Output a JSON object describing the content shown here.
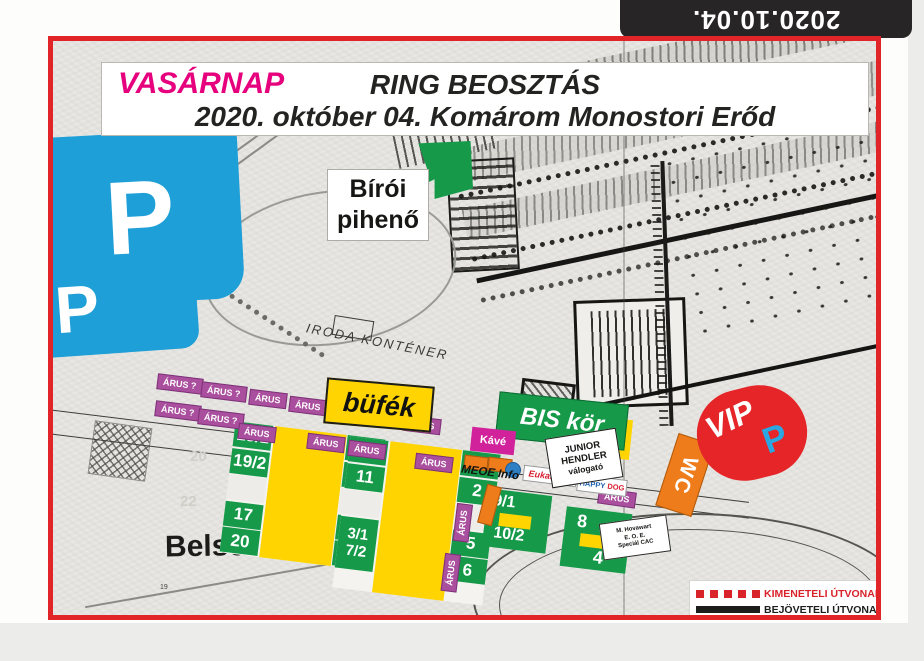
{
  "page": {
    "date_tag": "2020.10.04."
  },
  "header": {
    "day": "VASÁRNAP",
    "title": "RING BEOSZTÁS",
    "subtitle": "2020. október 04. Komárom Monostori Erőd"
  },
  "labels": {
    "parking_p": "P",
    "judge_rest_line1": "Bírói",
    "judge_rest_line2": "pihenő",
    "iroda": "IRODA KONTÉNER",
    "bufe": "büfék",
    "bis": "BIS kör",
    "kave": "Kávé",
    "junior_1": "JUNIOR",
    "junior_2": "HENDLER",
    "junior_3": "válogató",
    "meoe": "MEOE Info",
    "eukanuba": "Eukanuba",
    "happy_1": "HAPPY",
    "happy_2": "DOG",
    "wc": "WC",
    "vip": "VIP",
    "vip_p": "P",
    "belso": "Belso udvar",
    "hovawart_1": "M. Hovawart",
    "hovawart_2": "E. O. E.",
    "hovawart_3": "Speciál CAC"
  },
  "stalls": [
    {
      "t": "ÁRUS ?",
      "x": 104,
      "y": 335,
      "r": 7
    },
    {
      "t": "ÁRUS ?",
      "x": 148,
      "y": 343,
      "r": 7
    },
    {
      "t": "ÁRUS",
      "x": 196,
      "y": 350,
      "r": 7
    },
    {
      "t": "ÁRUS",
      "x": 236,
      "y": 357,
      "r": 7
    },
    {
      "t": "ÁRUS",
      "x": 350,
      "y": 376,
      "r": 7
    },
    {
      "t": "ÁRUS ?",
      "x": 102,
      "y": 362,
      "r": 7
    },
    {
      "t": "ÁRUS ?",
      "x": 145,
      "y": 370,
      "r": 7
    },
    {
      "t": "ÁRUS",
      "x": 185,
      "y": 384,
      "r": 7
    },
    {
      "t": "ÁRUS",
      "x": 254,
      "y": 394,
      "r": 7
    },
    {
      "t": "ÁRUS",
      "x": 295,
      "y": 401,
      "r": 7
    },
    {
      "t": "ÁRUS",
      "x": 362,
      "y": 414,
      "r": 7
    },
    {
      "t": "ÁRUS",
      "x": 391,
      "y": 474,
      "r": -83
    },
    {
      "t": "ÁRUS",
      "x": 379,
      "y": 524,
      "r": -83
    },
    {
      "t": "ÁRUS",
      "x": 545,
      "y": 449,
      "r": 8
    }
  ],
  "rings": {
    "block1": {
      "left": [
        "18/1",
        "19/2",
        "",
        "17",
        "20"
      ],
      "right": [
        "13",
        "14",
        "",
        "15",
        "16"
      ]
    },
    "block2": {
      "left": [
        "12",
        "11",
        "",
        "3/1\n7/2"
      ],
      "right": [
        "1",
        "2",
        "",
        "5",
        "6"
      ]
    },
    "block3": {
      "top": "9/1",
      "bottom": "10/2"
    },
    "block4": {
      "top": "8",
      "bottom": "4"
    }
  },
  "map_numbers": {
    "n20": "20",
    "n22": "22",
    "n19": "19"
  },
  "legend": {
    "exit": "KIMENETELI ÚTVONAL",
    "entry": "BEJÖVETELI ÚTVONAL"
  },
  "colors": {
    "frame": "#e02428",
    "tag": "#272525",
    "magenta": "#e6007d",
    "blue": "#1f9fd8",
    "green": "#169a49",
    "yellow": "#ffd400",
    "stall": "#a94f9e",
    "pink": "#d1219b",
    "orange": "#ee7c1b",
    "vip": "#e52528",
    "legendred": "#d8232a"
  }
}
